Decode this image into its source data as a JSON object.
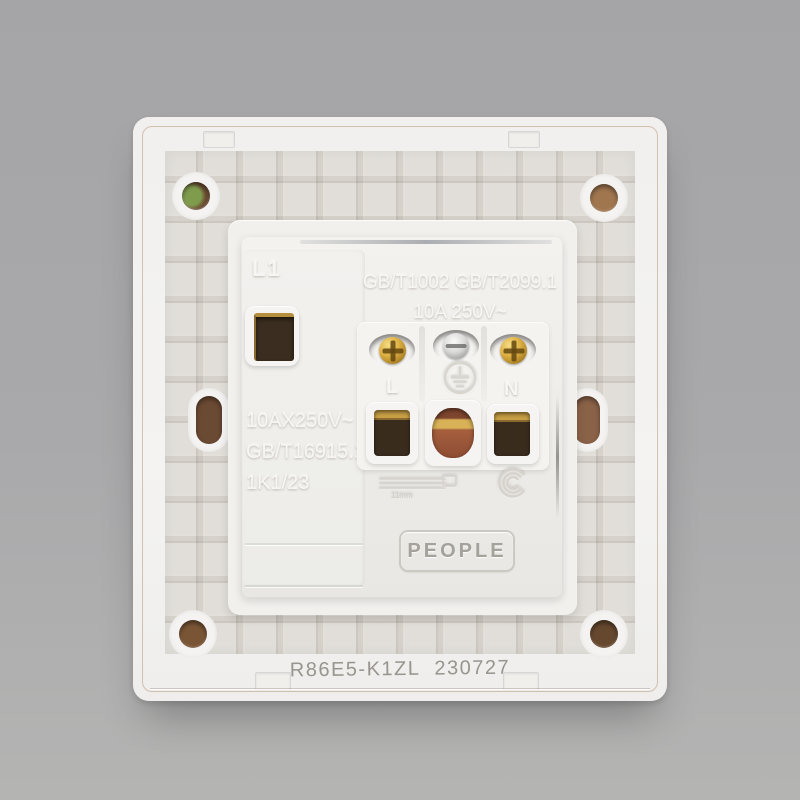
{
  "product": {
    "brand": "PEOPLE",
    "model_code": "R86E5-K1ZL",
    "date_code": "230727",
    "switch": {
      "channel_label": "L1",
      "rating": "10AX250V~",
      "standard": "GB/T16915.1",
      "batch_code": "1K1/23"
    },
    "socket": {
      "standards": "GB/T1002 GB/T2099.1",
      "rating": "10A 250V~",
      "terminal_live_label": "L",
      "terminal_neutral_label": "N"
    },
    "strip_gauge_label": "11mm",
    "icons": {
      "earth": "earth-terminal-icon",
      "certification": "ccc-certification-icon"
    }
  },
  "colors": {
    "background_gray": "#aaaaab",
    "plastic_white": "#f2f1ee",
    "brass": "#ddb042",
    "copper": "#a65f3e",
    "terminal_dark": "#3a2c1d",
    "etched_text": "#98948e"
  }
}
